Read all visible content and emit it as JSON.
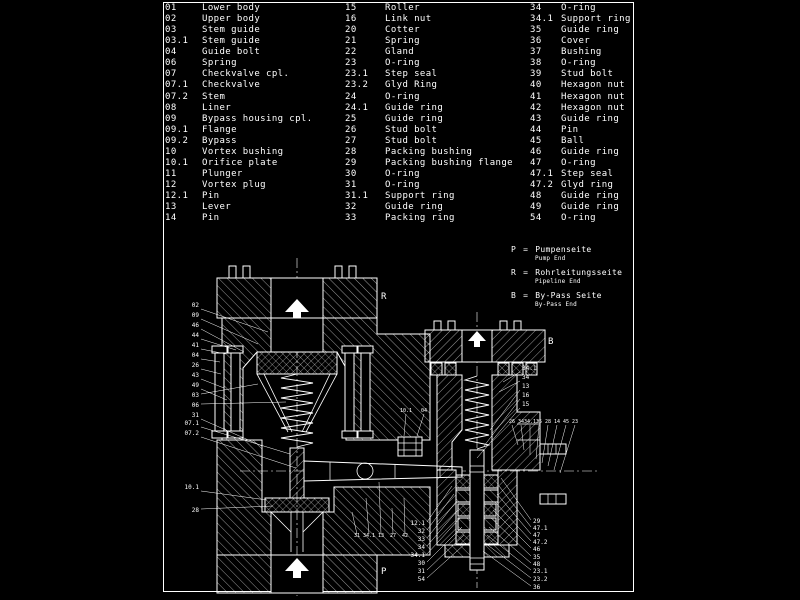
{
  "colors": {
    "background": "#000000",
    "ink": "#ffffff"
  },
  "parts_list": {
    "columns": [
      {
        "rows": [
          {
            "num": "01",
            "name": "Lower body"
          },
          {
            "num": "02",
            "name": "Upper body"
          },
          {
            "num": "03",
            "name": "Stem guide"
          },
          {
            "num": "03.1",
            "name": "Stem guide"
          },
          {
            "num": "04",
            "name": "Guide bolt"
          },
          {
            "num": "06",
            "name": "Spring"
          },
          {
            "num": "07",
            "name": "Checkvalve cpl."
          },
          {
            "num": "07.1",
            "name": "Checkvalve"
          },
          {
            "num": "07.2",
            "name": "Stem"
          },
          {
            "num": "08",
            "name": "Liner"
          },
          {
            "num": "09",
            "name": "Bypass housing cpl."
          },
          {
            "num": "09.1",
            "name": "Flange"
          },
          {
            "num": "09.2",
            "name": "Bypass"
          },
          {
            "num": "10",
            "name": "Vortex bushing"
          },
          {
            "num": "10.1",
            "name": "Orifice plate"
          },
          {
            "num": "11",
            "name": "Plunger"
          },
          {
            "num": "12",
            "name": "Vortex plug"
          },
          {
            "num": "12.1",
            "name": "Pin"
          },
          {
            "num": "13",
            "name": "Lever"
          },
          {
            "num": "14",
            "name": "Pin"
          }
        ]
      },
      {
        "rows": [
          {
            "num": "15",
            "name": "Roller"
          },
          {
            "num": "16",
            "name": "Link nut"
          },
          {
            "num": "20",
            "name": "Cotter"
          },
          {
            "num": "21",
            "name": "Spring"
          },
          {
            "num": "22",
            "name": "Gland"
          },
          {
            "num": "23",
            "name": "O-ring"
          },
          {
            "num": "23.1",
            "name": "Step seal"
          },
          {
            "num": "23.2",
            "name": "Glyd Ring"
          },
          {
            "num": "24",
            "name": "O-ring"
          },
          {
            "num": "24.1",
            "name": "Guide ring"
          },
          {
            "num": "25",
            "name": "Guide ring"
          },
          {
            "num": "26",
            "name": "Stud bolt"
          },
          {
            "num": "27",
            "name": "Stud bolt"
          },
          {
            "num": "28",
            "name": "Packing bushing"
          },
          {
            "num": "29",
            "name": "Packing bushing flange"
          },
          {
            "num": "30",
            "name": "O-ring"
          },
          {
            "num": "31",
            "name": "O-ring"
          },
          {
            "num": "31.1",
            "name": "Support ring"
          },
          {
            "num": "32",
            "name": "Guide ring"
          },
          {
            "num": "33",
            "name": "Packing ring"
          }
        ]
      },
      {
        "rows": [
          {
            "num": "34",
            "name": "O-ring"
          },
          {
            "num": "34.1",
            "name": "Support ring"
          },
          {
            "num": "35",
            "name": "Guide ring"
          },
          {
            "num": "36",
            "name": "Cover"
          },
          {
            "num": "37",
            "name": "Bushing"
          },
          {
            "num": "38",
            "name": "O-ring"
          },
          {
            "num": "39",
            "name": "Stud bolt"
          },
          {
            "num": "40",
            "name": "Hexagon nut"
          },
          {
            "num": "41",
            "name": "Hexagon nut"
          },
          {
            "num": "42",
            "name": "Hexagon nut"
          },
          {
            "num": "43",
            "name": "Guide ring"
          },
          {
            "num": "44",
            "name": "Pin"
          },
          {
            "num": "45",
            "name": "Ball"
          },
          {
            "num": "46",
            "name": "Guide ring"
          },
          {
            "num": "47",
            "name": "O-ring"
          },
          {
            "num": "47.1",
            "name": "Step seal"
          },
          {
            "num": "47.2",
            "name": "Glyd ring"
          },
          {
            "num": "48",
            "name": "Guide ring"
          },
          {
            "num": "49",
            "name": "Guide ring"
          },
          {
            "num": "54",
            "name": "O-ring"
          }
        ]
      }
    ]
  },
  "legend": {
    "entries": [
      {
        "letter": "P",
        "eq": "=",
        "de": "Pumpenseite",
        "en": "Pump End"
      },
      {
        "letter": "R",
        "eq": "=",
        "de": "Rohrleitungsseite",
        "en": "Pipeline End"
      },
      {
        "letter": "B",
        "eq": "=",
        "de": "By-Pass Seite",
        "en": "By-Pass End"
      }
    ]
  },
  "drawing": {
    "markers": [
      {
        "label": "R",
        "x": 381,
        "y": 299
      },
      {
        "label": "B",
        "x": 548,
        "y": 344
      },
      {
        "label": "P",
        "x": 381,
        "y": 574
      }
    ],
    "callouts": [
      {
        "label": "02",
        "x": 199,
        "y": 307,
        "a": "end",
        "tx": 268,
        "ty": 332
      },
      {
        "label": "09",
        "x": 199,
        "y": 317,
        "a": "end",
        "tx": 258,
        "ty": 344
      },
      {
        "label": "46",
        "x": 199,
        "y": 327,
        "a": "end",
        "tx": 244,
        "ty": 352
      },
      {
        "label": "44",
        "x": 199,
        "y": 337,
        "a": "end",
        "tx": 236,
        "ty": 350
      },
      {
        "label": "41",
        "x": 199,
        "y": 347,
        "a": "end",
        "tx": 226,
        "ty": 354
      },
      {
        "label": "04",
        "x": 199,
        "y": 357,
        "a": "end",
        "tx": 220,
        "ty": 362
      },
      {
        "label": "26",
        "x": 199,
        "y": 367,
        "a": "end",
        "tx": 221,
        "ty": 374
      },
      {
        "label": "43",
        "x": 199,
        "y": 377,
        "a": "end",
        "tx": 224,
        "ty": 388
      },
      {
        "label": "49",
        "x": 199,
        "y": 387,
        "a": "end",
        "tx": 227,
        "ty": 400
      },
      {
        "label": "03",
        "x": 199,
        "y": 397,
        "a": "end",
        "tx": 258,
        "ty": 384
      },
      {
        "label": "06",
        "x": 199,
        "y": 407,
        "a": "end",
        "tx": 286,
        "ty": 402
      },
      {
        "label": "31",
        "x": 199,
        "y": 417,
        "a": "end",
        "tx": 262,
        "ty": 446
      },
      {
        "label": "07.1",
        "x": 199,
        "y": 425,
        "a": "end",
        "tx": 290,
        "ty": 454
      },
      {
        "label": "07.2",
        "x": 199,
        "y": 435,
        "a": "end",
        "tx": 296,
        "ty": 468
      },
      {
        "label": "10.1",
        "x": 199,
        "y": 489,
        "a": "end",
        "tx": 267,
        "ty": 500
      },
      {
        "label": "28",
        "x": 199,
        "y": 512,
        "a": "end",
        "tx": 273,
        "ty": 506
      },
      {
        "label": "34.1",
        "x": 522,
        "y": 370,
        "a": "start",
        "tx": 503,
        "ty": 382
      },
      {
        "label": "34",
        "x": 522,
        "y": 379,
        "a": "start",
        "tx": 499,
        "ty": 392
      },
      {
        "label": "13",
        "x": 522,
        "y": 388,
        "a": "start",
        "tx": 490,
        "ty": 430
      },
      {
        "label": "16",
        "x": 522,
        "y": 397,
        "a": "start",
        "tx": 484,
        "ty": 446
      },
      {
        "label": "15",
        "x": 522,
        "y": 406,
        "a": "start",
        "tx": 477,
        "ty": 458
      },
      {
        "label": "26",
        "x": 512,
        "y": 423,
        "a": "middle",
        "s": 5,
        "tx": 518,
        "ty": 445
      },
      {
        "label": "34",
        "x": 521,
        "y": 423,
        "a": "middle",
        "s": 5,
        "tx": 524,
        "ty": 450
      },
      {
        "label": "34.1",
        "x": 530,
        "y": 423,
        "a": "middle",
        "s": 5,
        "tx": 530,
        "ty": 455
      },
      {
        "label": "35",
        "x": 539,
        "y": 423,
        "a": "middle",
        "s": 5,
        "tx": 536,
        "ty": 459
      },
      {
        "label": "28",
        "x": 548,
        "y": 423,
        "a": "middle",
        "s": 5,
        "tx": 542,
        "ty": 463
      },
      {
        "label": "14",
        "x": 557,
        "y": 423,
        "a": "middle",
        "s": 5,
        "tx": 548,
        "ty": 466
      },
      {
        "label": "45",
        "x": 566,
        "y": 423,
        "a": "middle",
        "s": 5,
        "tx": 554,
        "ty": 470
      },
      {
        "label": "23",
        "x": 575,
        "y": 423,
        "a": "middle",
        "s": 5,
        "tx": 560,
        "ty": 473
      },
      {
        "label": "10.1",
        "x": 406,
        "y": 412,
        "a": "middle",
        "s": 5,
        "tx": 404,
        "ty": 436
      },
      {
        "label": "04",
        "x": 424,
        "y": 412,
        "a": "middle",
        "s": 5,
        "tx": 417,
        "ty": 436
      },
      {
        "label": "12.1",
        "x": 425,
        "y": 525,
        "a": "end",
        "tx": 452,
        "ty": 486
      },
      {
        "label": "32",
        "x": 425,
        "y": 533,
        "a": "end",
        "tx": 454,
        "ty": 494
      },
      {
        "label": "33",
        "x": 425,
        "y": 541,
        "a": "end",
        "tx": 456,
        "ty": 502
      },
      {
        "label": "34",
        "x": 425,
        "y": 549,
        "a": "end",
        "tx": 458,
        "ty": 510
      },
      {
        "label": "34.1",
        "x": 425,
        "y": 557,
        "a": "end",
        "tx": 460,
        "ty": 518
      },
      {
        "label": "30",
        "x": 425,
        "y": 565,
        "a": "end",
        "tx": 462,
        "ty": 527
      },
      {
        "label": "31",
        "x": 425,
        "y": 573,
        "a": "end",
        "tx": 464,
        "ty": 535
      },
      {
        "label": "54",
        "x": 425,
        "y": 581,
        "a": "end",
        "tx": 466,
        "ty": 543
      },
      {
        "label": "31",
        "x": 357,
        "y": 537,
        "a": "middle",
        "s": 5,
        "tx": 352,
        "ty": 512
      },
      {
        "label": "34.1",
        "x": 369,
        "y": 537,
        "a": "middle",
        "s": 5,
        "tx": 366,
        "ty": 498
      },
      {
        "label": "13",
        "x": 381,
        "y": 537,
        "a": "middle",
        "s": 5,
        "tx": 379,
        "ty": 482
      },
      {
        "label": "27",
        "x": 393,
        "y": 537,
        "a": "middle",
        "s": 5,
        "tx": 392,
        "ty": 508
      },
      {
        "label": "42",
        "x": 405,
        "y": 537,
        "a": "middle",
        "s": 5,
        "tx": 404,
        "ty": 498
      },
      {
        "label": "29",
        "x": 533,
        "y": 523,
        "a": "start",
        "tx": 501,
        "ty": 478
      },
      {
        "label": "47.1",
        "x": 533,
        "y": 530,
        "a": "start",
        "tx": 499,
        "ty": 486
      },
      {
        "label": "47",
        "x": 533,
        "y": 537,
        "a": "start",
        "tx": 497,
        "ty": 494
      },
      {
        "label": "47.2",
        "x": 533,
        "y": 544,
        "a": "start",
        "tx": 495,
        "ty": 502
      },
      {
        "label": "46",
        "x": 533,
        "y": 551,
        "a": "start",
        "tx": 493,
        "ty": 510
      },
      {
        "label": "35",
        "x": 533,
        "y": 559,
        "a": "start",
        "tx": 491,
        "ty": 518
      },
      {
        "label": "48",
        "x": 533,
        "y": 566,
        "a": "start",
        "tx": 489,
        "ty": 527
      },
      {
        "label": "23.1",
        "x": 533,
        "y": 573,
        "a": "start",
        "tx": 487,
        "ty": 535
      },
      {
        "label": "23.2",
        "x": 533,
        "y": 581,
        "a": "start",
        "tx": 485,
        "ty": 543
      },
      {
        "label": "36",
        "x": 533,
        "y": 589,
        "a": "start",
        "tx": 483,
        "ty": 551
      }
    ]
  }
}
